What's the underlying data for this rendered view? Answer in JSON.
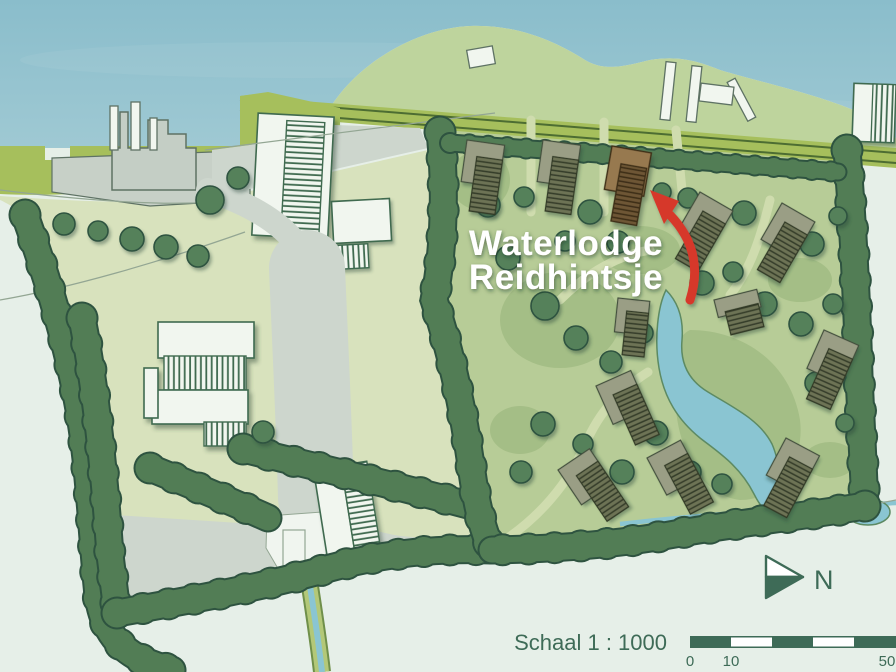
{
  "title": {
    "line1": "Waterlodge",
    "line2": "Reidhintsje"
  },
  "compass": {
    "label": "N"
  },
  "scale_bar": {
    "label": "Schaal 1 : 1000",
    "ticks": [
      "0",
      "10",
      "50"
    ]
  },
  "colors": {
    "sea_top": "#8abdcb",
    "sea_low": "#abd0d8",
    "land_pale": "#e6efe8",
    "field": "#d8e2bd",
    "dune": "#bed49d",
    "road_olive": "#a6bf5c",
    "road_line": "#4d6d32",
    "road_gray": "#cdd6cd",
    "platform": "#c7d0c7",
    "industry_stroke": "#5e7264",
    "hedge_fill": "#527d55",
    "hedge_outline": "#2e5340",
    "tree": "#55815a",
    "resort": "#b7cc97",
    "resort_dark": "#8fae72",
    "pond": "#8ac5d2",
    "pond_stroke": "#5d8a63",
    "bld_white": "#f1f6ef",
    "bld_stroke": "#3f6a50",
    "lodge_light": "#9a9e85",
    "lodge_hbg": "#6d7355",
    "lodge_hline": "#333a28",
    "lodge_stroke": "#43503c",
    "hl_light": "#97794f",
    "hl_hbg": "#6e5736",
    "hl_hline": "#3a2b14",
    "hl_stroke": "#3c2e18",
    "arrow_red": "#d6392a",
    "title_white": "#ffffff",
    "ink": "#3e6b57",
    "canal_bank": "#b3c878",
    "path_light": "#cfdcae",
    "yard_white": "#f0f5ef",
    "track": "#93a693"
  }
}
